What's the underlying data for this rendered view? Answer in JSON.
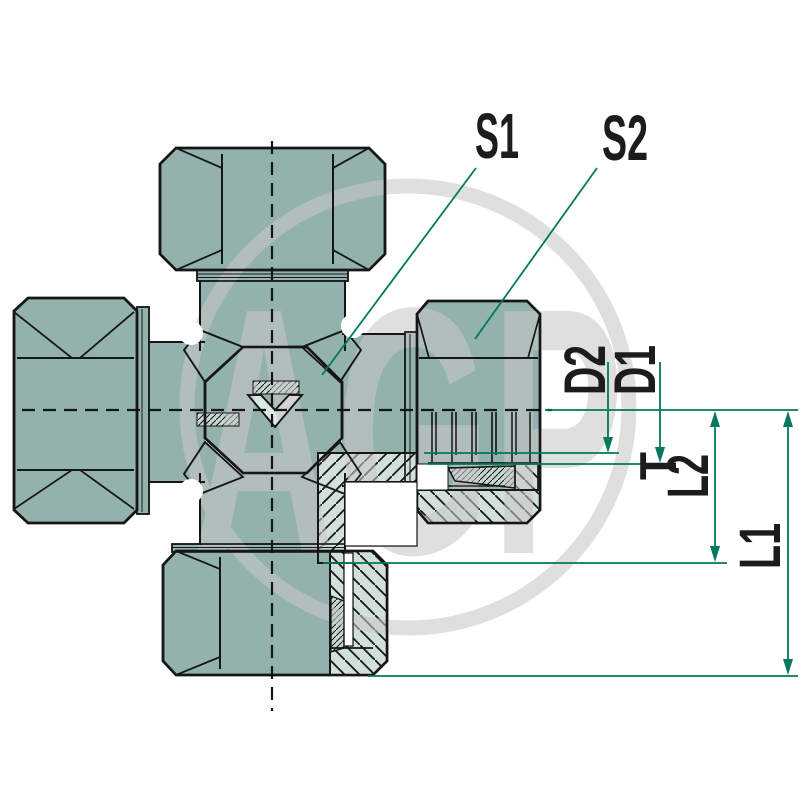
{
  "drawing": {
    "title": "Cross fitting dimensional drawing",
    "dimension_labels": {
      "s1": "S1",
      "s2": "S2",
      "d2": "D2",
      "d1": "D1",
      "t": "T",
      "l2": "L2",
      "l1": "L1"
    },
    "watermark_text": "AGP",
    "colors": {
      "metal": "#93b1ad",
      "section_fill": "#d2e0dc",
      "fine_section_fill": "#c6d8d3",
      "dimension_line": "#00795c",
      "outline": "#161616",
      "watermark": "#c9c9c9"
    }
  }
}
